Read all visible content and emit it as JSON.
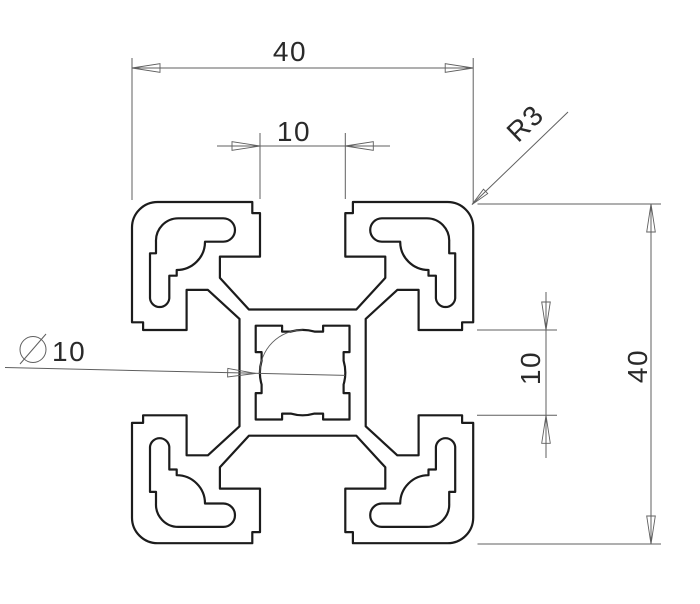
{
  "drawing": {
    "type": "technical-cross-section",
    "subject": "aluminum-extrusion-t-slot-profile-40x40",
    "dimensions": {
      "overall_width": "40",
      "slot_width_top": "10",
      "corner_radius": "R3",
      "center_bore_label": "10",
      "center_bore_symbol": "diameter",
      "slot_width_right": "10",
      "overall_height": "40"
    },
    "colors": {
      "background": "#ffffff",
      "outline": "#1c1c1c",
      "dimension": "#5f5f5f",
      "text": "#2a2a2a"
    }
  }
}
